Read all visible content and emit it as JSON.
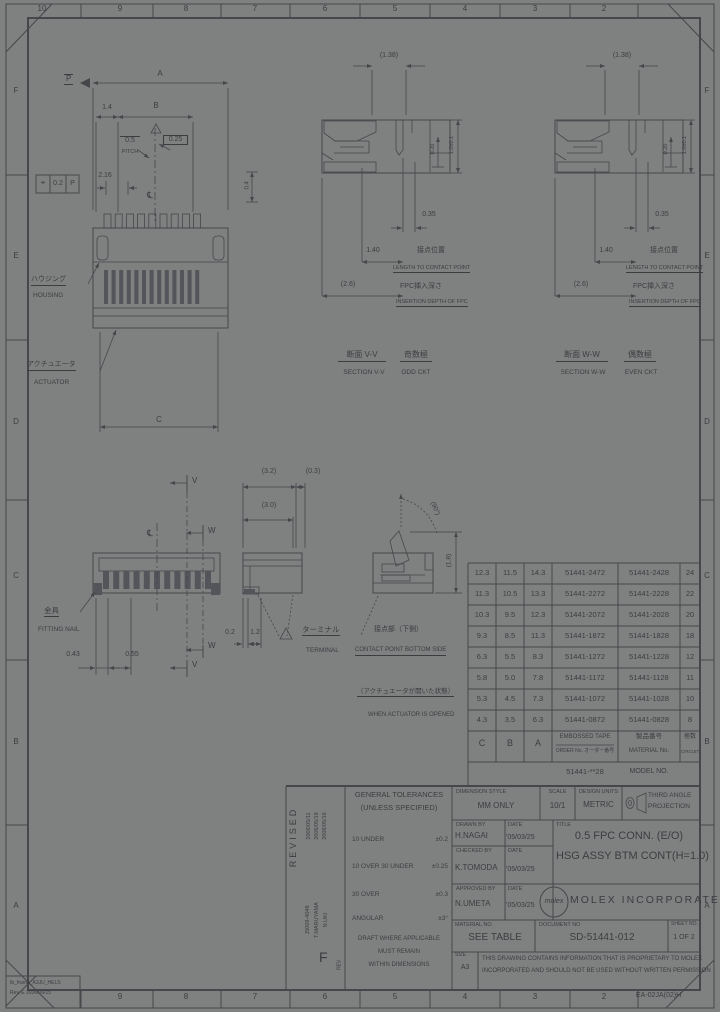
{
  "sheet": {
    "zones_top": [
      "10",
      "9",
      "8",
      "7",
      "6",
      "5",
      "4",
      "3",
      "2"
    ],
    "zones_bottom": [
      "9",
      "8",
      "7",
      "6",
      "5",
      "4",
      "3",
      "2"
    ],
    "zones_left": [
      "F",
      "E",
      "D",
      "C",
      "B",
      "A"
    ],
    "zones_right": [
      "F",
      "E",
      "D",
      "C",
      "B",
      "A"
    ],
    "form_code": "EA-02JA(02)H",
    "frame_note_line1": "tb_frame_A3JU_HELS",
    "frame_note_line2": "Rev. E 2006/06/15"
  },
  "views": {
    "top_view": {
      "datum_p": "P",
      "dim_a": "A",
      "dim_1_4": "1.4",
      "dim_b": "B",
      "pitch_value": "0.5",
      "pitch_label": "PITCH",
      "dim_0_25": "0.25",
      "dim_2_16": "2.16",
      "gdt_symbol": "⌖",
      "gdt_value": "0.2",
      "gdt_datum": "P",
      "centerline": "℄",
      "dim_0_4": "0.4",
      "dim_c": "C",
      "housing_jp": "ハウジング",
      "housing_en": "HOUSING",
      "actuator_jp": "アクチュエータ",
      "actuator_en": "ACTUATOR"
    },
    "section_v": {
      "dim_width": "(1.38)",
      "dim_0_35": "0.35",
      "dim_len": "1.40",
      "dim_depth": "(2.6)",
      "dim_h_inner": "0.20",
      "dim_h_outer": "1.0±0.1",
      "contact_jp": "接点位置",
      "contact_en": "LENGTH TO CONTACT POINT",
      "depth_jp": "FPC挿入深さ",
      "depth_en": "INSERTION DEPTH OF FPC",
      "caption_jp": "断面 V-V",
      "caption_en": "SECTION V-V",
      "ckt_jp": "奇数極",
      "ckt_en": "ODD CKT"
    },
    "section_w": {
      "dim_width": "(1.38)",
      "dim_0_35": "0.35",
      "dim_len": "1.40",
      "dim_depth": "(2.6)",
      "dim_h_inner": "0.20",
      "dim_h_outer": "1.0±0.1",
      "contact_jp": "接点位置",
      "contact_en": "LENGTH TO CONTACT POINT",
      "depth_jp": "FPC挿入深さ",
      "depth_en": "INSERTION DEPTH OF FPC",
      "caption_jp": "断面 W-W",
      "caption_en": "SECTION W-W",
      "ckt_jp": "偶数極",
      "ckt_en": "EVEN CKT"
    },
    "front_view": {
      "cut_v": "V",
      "cut_w": "W",
      "centerline": "℄",
      "dim_left": "0.43",
      "dim_right": "0.55",
      "fitting_jp": "金具",
      "fitting_en": "FITTING NAIL"
    },
    "side_view": {
      "dim_3_2": "(3.2)",
      "dim_0_3": "(0.3)",
      "dim_3_0": "(3.0)",
      "dim_0_2": "0.2",
      "dim_1_2": "1.2",
      "terminal_jp": "ターミナル",
      "terminal_en": "TERMINAL"
    },
    "open_view": {
      "angle": "(90°)",
      "dim_1_8": "(1.8)",
      "contact_jp": "接点部（下側）",
      "contact_en": "CONTACT POINT BOTTOM SIDE",
      "state_jp": "（アクチュエータが開いた状態）",
      "state_en": "WHEN ACTUATOR IS OPENED"
    }
  },
  "parts_table": {
    "headers": {
      "c": "C",
      "b": "B",
      "a": "A",
      "order_l1": "EMBOSSED TAPE",
      "order_l2": "ORDER No. オーダー番号",
      "material_l1": "製品番号",
      "material_l2": "MATERIAL No.",
      "circuit_l1": "極数",
      "circuit_l2": "CIRCUIT"
    },
    "rows": [
      [
        "12.3",
        "11.5",
        "14.3",
        "51441-2472",
        "51441-2428",
        "24"
      ],
      [
        "11.3",
        "10.5",
        "13.3",
        "51441-2272",
        "51441-2228",
        "22"
      ],
      [
        "10.3",
        "9.5",
        "12.3",
        "51441-2072",
        "51441-2028",
        "20"
      ],
      [
        "9.3",
        "8.5",
        "11.3",
        "51441-1872",
        "51441-1828",
        "18"
      ],
      [
        "6.3",
        "5.5",
        "8.3",
        "51441-1272",
        "51441-1228",
        "12"
      ],
      [
        "5.8",
        "5.0",
        "7.8",
        "51441-1172",
        "51441-1128",
        "11"
      ],
      [
        "5.3",
        "4.5",
        "7.3",
        "51441-1072",
        "51441-1028",
        "10"
      ],
      [
        "4.3",
        "3.5",
        "6.3",
        "51441-0872",
        "51441-0828",
        "8"
      ]
    ],
    "model_series": "51441-**28",
    "model_label": "MODEL NO."
  },
  "title_block": {
    "revised_label": "REVISED",
    "revision_dates": [
      "2006/05/11",
      "2006/05/18",
      "2008/05/16"
    ],
    "revision_refs": [
      "J5009-4048",
      "T.MARUYAMA",
      "N.UKI"
    ],
    "rev_letter": "F",
    "rev_label": "REV",
    "tol_title_l1": "GENERAL TOLERANCES",
    "tol_title_l2": "(UNLESS SPECIFIED)",
    "tol_rows": [
      {
        "label": "10 UNDER",
        "value": "±0.2"
      },
      {
        "label": "10 OVER 30 UNDER",
        "value": "±0.25"
      },
      {
        "label": "30 OVER",
        "value": "±0.3"
      },
      {
        "label": "ANGULAR",
        "value": "±3°"
      }
    ],
    "tol_note_l1": "DRAFT WHERE APPLICABLE",
    "tol_note_l2": "MUST REMAIN",
    "tol_note_l3": "WITHIN DIMENSIONS",
    "dim_style_label": "DIMENSION STYLE",
    "dim_style": "MM ONLY",
    "scale_label": "SCALE",
    "scale": "10/1",
    "units_label": "DESIGN UNITS",
    "units": "METRIC",
    "proj_l1": "THIRD ANGLE",
    "proj_l2": "PROJECTION",
    "title_label": "TITLE",
    "drawn_label": "DRAWN BY",
    "drawn_name": "H.NAGAI",
    "checked_label": "CHECKED BY",
    "checked_name": "K.TOMODA",
    "approved_label": "APPROVED BY",
    "approved_name": "N.UMETA",
    "date_label": "DATE",
    "date_drawn": "'05/03/25",
    "date_checked": "'05/03/25",
    "date_approved": "'05/03/25",
    "title_l1": "0.5 FPC CONN. (E/O)",
    "title_l2": "HSG ASSY BTM CONT(H=1.0)",
    "logo_text": "molex",
    "company": "MOLEX INCORPORATED",
    "material_label": "MATERIAL NO.",
    "material": "SEE TABLE",
    "document_label": "DOCUMENT NO",
    "document": "SD-51441-012",
    "sheet_label": "SHEET NO.",
    "sheet_value": "1 OF 2",
    "size_label": "SIZE",
    "size_value": "A3",
    "note_l1": "THIS DRAWING CONTAINS INFORMATION THAT IS PROPRIETARY TO MOLEX",
    "note_l2": "INCORPORATED AND SHOULD NOT BE USED WITHOUT WRITTEN PERMISSION"
  }
}
